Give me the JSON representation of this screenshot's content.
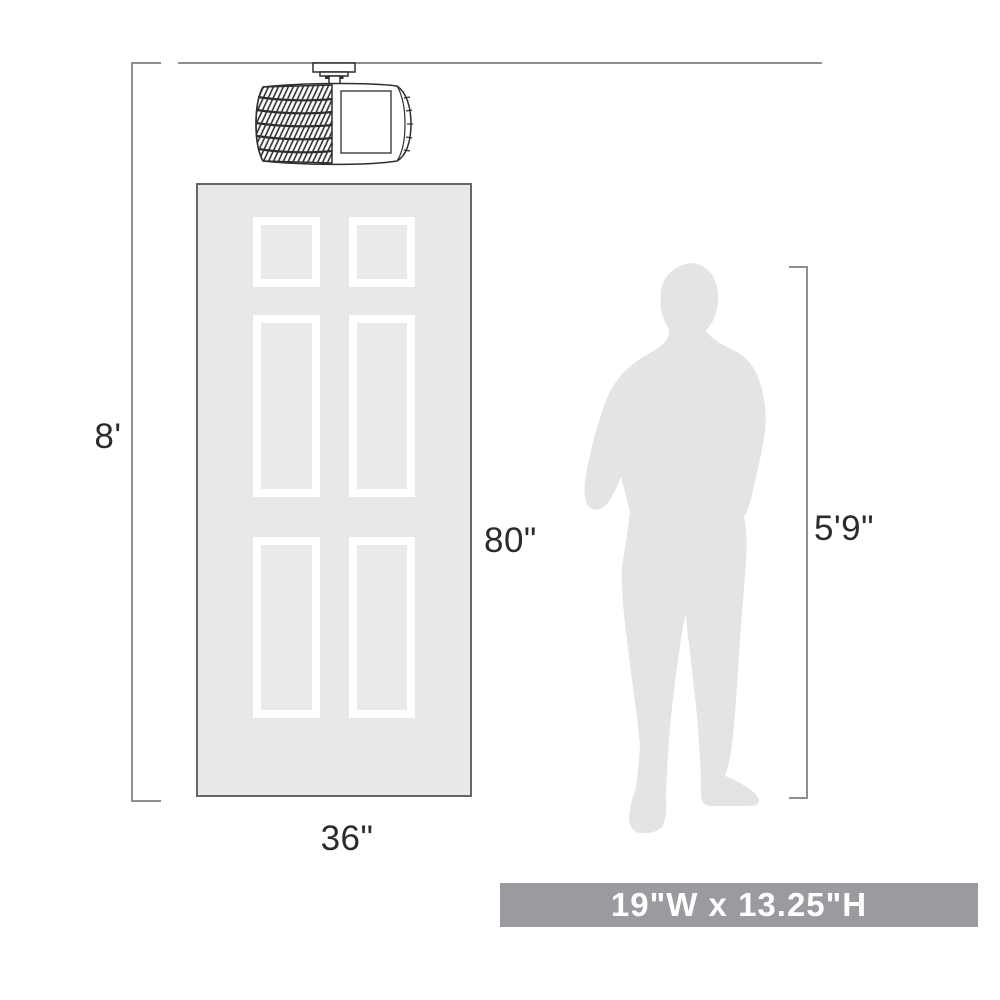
{
  "diagram_type": "product-scale-dimensions",
  "labels": {
    "ceiling_height": "8'",
    "door_height": "80\"",
    "door_width": "36\"",
    "person_height": "5'9\""
  },
  "banner": {
    "product_dimensions": "19\"W x 13.25\"H"
  },
  "illustrations": {
    "fixture": "semi-flush-drum-crystal-light-fixture",
    "door": "six-panel-door",
    "person": "standing-man-silhouette"
  },
  "colors": {
    "background": "#ffffff",
    "dimension_line": "#8f8f8f",
    "fixture_line": "#2e2e2e",
    "door_fill": "#e8e8e9",
    "door_border": "#666668",
    "panel_border": "#ffffff",
    "silhouette_fill": "#e3e4e6",
    "banner_fill": "#9a9b9e",
    "banner_text": "#ffffff",
    "label_text": "#2b2b2b"
  }
}
